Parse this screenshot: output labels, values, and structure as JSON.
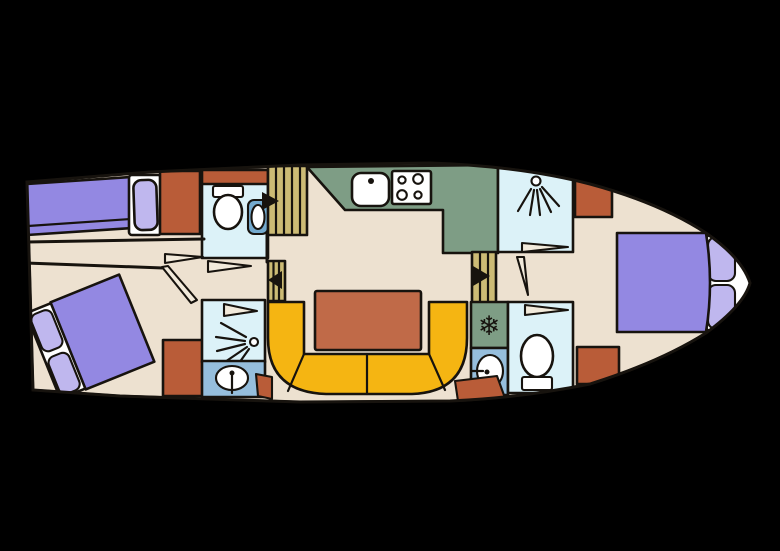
{
  "canvas": {
    "width": 780,
    "height": 551
  },
  "colors": {
    "background": "#000000",
    "outline": "#17130e",
    "floor": "#ede1d0",
    "bed": "#9388e2",
    "pillow": "#bfb7ee",
    "white": "#ffffff",
    "terracotta": "#b95c38",
    "table": "#c06a48",
    "sofa": "#f5b512",
    "galley": "#7e9d85",
    "wetroom": "#dcf2f8",
    "sinkroom": "#96bedc",
    "fixture": "#74aace",
    "stairs": "#ccbb75",
    "door": "#f2eadb",
    "icon": "#17130e"
  },
  "icons": {
    "snowflake": "❄",
    "shower": "spray-fan",
    "toilet": "bowl-and-tank",
    "sink": "oval-basin-with-tap",
    "stove": "four-burner-hob",
    "stairs_arrow": "solid-triangle"
  }
}
